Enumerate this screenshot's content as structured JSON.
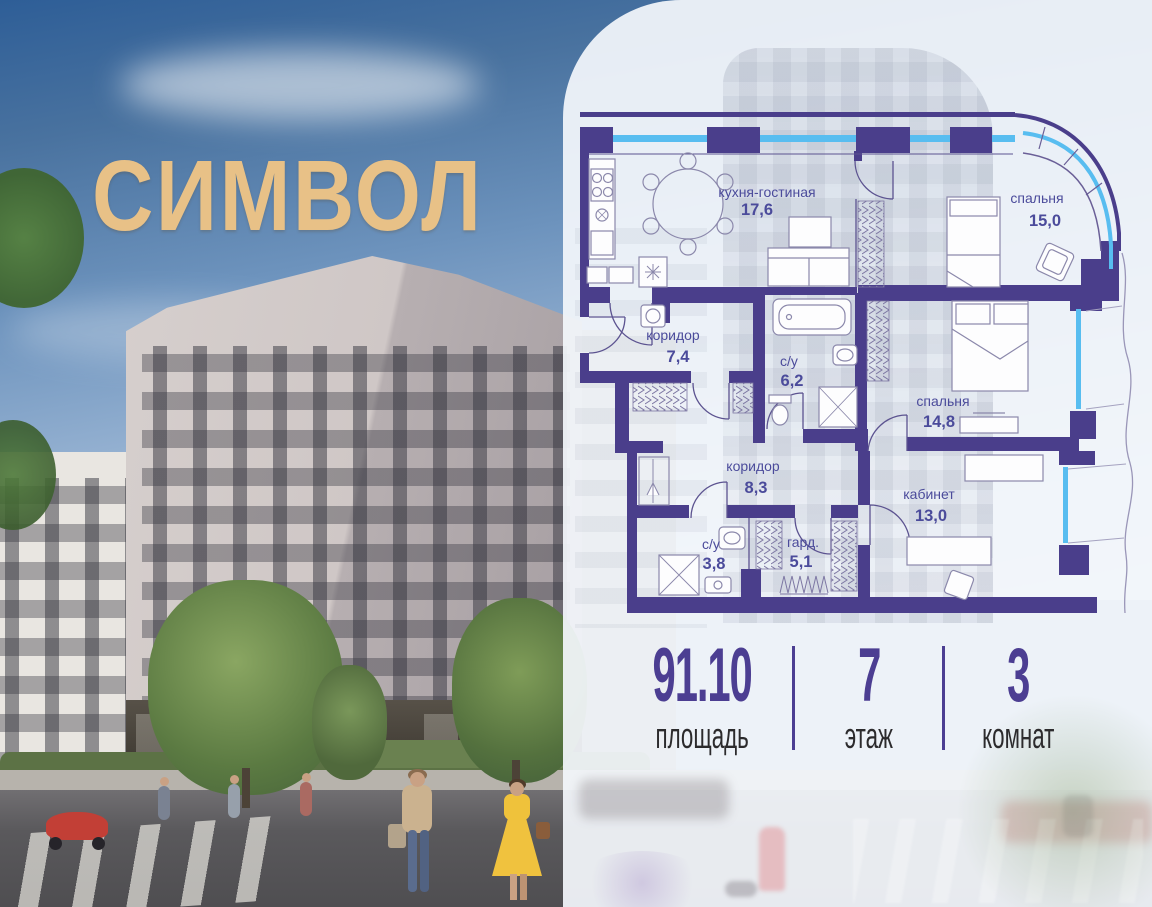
{
  "brand": {
    "logo_text": "СИМВОЛ"
  },
  "floor_plan": {
    "rooms": [
      {
        "name": "кухня-гостиная",
        "area": "17,6"
      },
      {
        "name": "спальня",
        "area": "15,0"
      },
      {
        "name": "коридор",
        "area": "7,4"
      },
      {
        "name": "с/у",
        "area": "6,2"
      },
      {
        "name": "спальня",
        "area": "14,8"
      },
      {
        "name": "коридор",
        "area": "8,3"
      },
      {
        "name": "с/у",
        "area": "3,8"
      },
      {
        "name": "гард.",
        "area": "5,1"
      },
      {
        "name": "кабинет",
        "area": "13,0"
      }
    ]
  },
  "stats": [
    {
      "value": "91.10",
      "label": "площадь"
    },
    {
      "value": "7",
      "label": "этаж"
    },
    {
      "value": "3",
      "label": "комнат"
    }
  ],
  "colors": {
    "wall": "#4a3e8b",
    "accent": "#4c3e92",
    "glazing": "#58bdf0",
    "room_label": "#4b4b9b",
    "logo_gold": "#e8c187"
  }
}
